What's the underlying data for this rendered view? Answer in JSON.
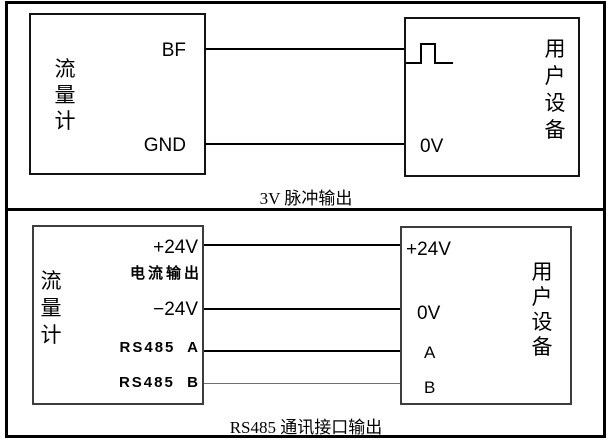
{
  "diagram": {
    "colors": {
      "line": "#000000",
      "light_wire": "#707070",
      "background": "#ffffff"
    },
    "panels": [
      {
        "caption": "3V 脉冲输出",
        "flowmeter": {
          "name": "流量计",
          "name_chars": [
            "流",
            "量",
            "计"
          ],
          "terminals": [
            {
              "label": "BF"
            },
            {
              "label": "GND"
            }
          ]
        },
        "device": {
          "name": "用户设备",
          "name_chars": [
            "用",
            "户",
            "设",
            "备"
          ],
          "pulse_icon": "square-pulse",
          "terminals": [
            {
              "label": "0V"
            }
          ]
        },
        "wires": [
          {
            "from": "BF",
            "to": "pulse-input"
          },
          {
            "from": "GND",
            "to": "0V"
          }
        ]
      },
      {
        "caption": "RS485 通讯接口输出",
        "flowmeter": {
          "name": "流量计",
          "name_chars": [
            "流",
            "量",
            "计"
          ],
          "terminals": [
            {
              "label": "+24V"
            },
            {
              "label": "电流输出"
            },
            {
              "label": "−24V"
            },
            {
              "label": "RS485  A"
            },
            {
              "label": "RS485  B"
            }
          ]
        },
        "device": {
          "name": "用户设备",
          "name_chars": [
            "用",
            "户",
            "设",
            "备"
          ],
          "terminals": [
            {
              "label": "+24V"
            },
            {
              "label": "0V"
            },
            {
              "label": "A"
            },
            {
              "label": "B"
            }
          ]
        },
        "wires": [
          {
            "from": "+24V",
            "to": "+24V"
          },
          {
            "from": "−24V",
            "to": "0V"
          },
          {
            "from": "RS485 A",
            "to": "A"
          },
          {
            "from": "RS485 B",
            "to": "B"
          }
        ]
      }
    ]
  }
}
